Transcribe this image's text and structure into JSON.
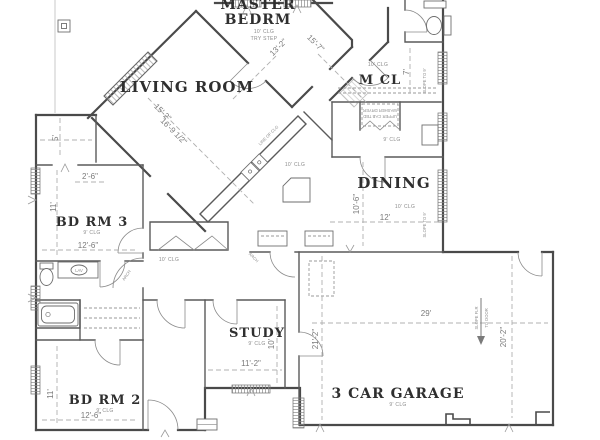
{
  "rooms": {
    "master": {
      "line1": "MASTER",
      "line2": "BEDRM",
      "clg": "10' CLG",
      "note": "TRY STEP",
      "dim1": "13'-2\"",
      "dim2": "15'-7\""
    },
    "living": {
      "name": "LIVING ROOM",
      "dim1": "15'-2\"",
      "dim2": "16'-9 1/2\""
    },
    "mcl": {
      "name": "M CL",
      "clg": "10' CLG",
      "dim": "7'"
    },
    "dining": {
      "name": "DINING",
      "clg": "10' CLG",
      "dim_w": "12'",
      "dim_h": "10'-6\""
    },
    "bdrm3": {
      "name": "BD RM 3",
      "clg": "9' CLG",
      "dim_w": "12'-6\"",
      "dim_h": "11'"
    },
    "bdrm2": {
      "name": "BD RM 2",
      "clg": "9' CLG",
      "dim_w": "12'-6\"",
      "dim_h": "11'"
    },
    "study": {
      "name": "STUDY",
      "clg": "9' CLG",
      "dim_w": "11'-2\"",
      "dim_h": "10'"
    },
    "garage": {
      "name": "3 CAR GARAGE",
      "clg": "9' CLG",
      "dim_w": "29'",
      "dim_h": "20'-2\"",
      "dim_side": "21'-2\""
    }
  },
  "dims": {
    "closet_depth": "5'",
    "closet_width": "2'-6\""
  },
  "notes": {
    "hall_clg": "10' CLG",
    "kitchen_clg": "10' CLG",
    "hall2_clg": "9' CLG",
    "slope1": "SLOPE TO 9'",
    "slope2": "SLOPE TO 9'",
    "arch1": "ARCH",
    "arch2": "ARCH",
    "lav": "LAV",
    "laundry1": "WASHER DRYER",
    "laundry2": "UPPER CAB TBD",
    "line_of": "LINE OF CLG",
    "garage_slope1": "SLOPE FLR",
    "garage_slope2": "TO DOOR"
  },
  "colors": {
    "wall": "#4a4a4a",
    "dimension_line": "#b0b0b0",
    "room_text": "#2f2f2f",
    "dim_text": "#7a7a7a"
  }
}
